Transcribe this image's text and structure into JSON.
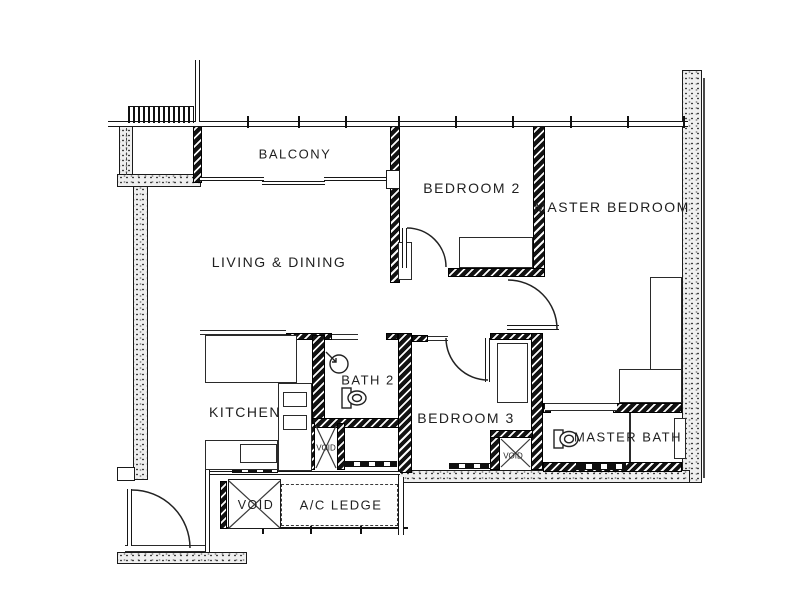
{
  "rooms": {
    "balcony": {
      "label": "BALCONY"
    },
    "living_dining": {
      "label": "LIVING & DINING"
    },
    "bedroom_2": {
      "label": "BEDROOM 2"
    },
    "master_bedroom": {
      "label": "MASTER BEDROOM"
    },
    "kitchen": {
      "label": "KITCHEN"
    },
    "bath_2": {
      "label": "BATH 2"
    },
    "bedroom_3": {
      "label": "BEDROOM 3"
    },
    "master_bath": {
      "label": "MASTER BATH"
    },
    "void_main": {
      "label": "VOID"
    },
    "ac_ledge": {
      "label": "A/C LEDGE"
    },
    "void_shaft_kitchen": {
      "label": "VOID"
    },
    "void_shaft_bedroom3": {
      "label": "VOID"
    }
  },
  "colors": {
    "line": "#1a1a1a",
    "wall_hatch": "#121212",
    "paper": "#ffffff"
  }
}
